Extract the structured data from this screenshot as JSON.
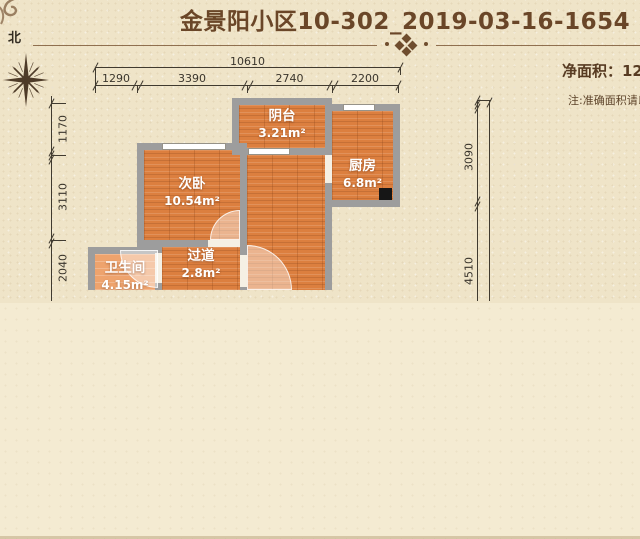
{
  "header": {
    "title": "金景阳小区10-302_2019-03-16-1654"
  },
  "compass": {
    "north_label": "北"
  },
  "info": {
    "net_area": "净面积：124",
    "note": "注:准确面积请以"
  },
  "dimensions": {
    "top_total": "10610",
    "top_segments": [
      "1290",
      "3390",
      "2740",
      "2200"
    ],
    "left_segments": [
      "1170",
      "3110",
      "2040"
    ],
    "right_segments": [
      "3090",
      "4510"
    ]
  },
  "rooms": {
    "balcony": {
      "name": "阴台",
      "area": "3.21m²"
    },
    "kitchen": {
      "name": "厨房",
      "area": "6.8m²"
    },
    "bedroom": {
      "name": "次卧",
      "area": "10.54m²"
    },
    "hallway": {
      "name": "过道",
      "area": "2.8m²"
    },
    "bathroom": {
      "name": "卫生间",
      "area": "4.15m²"
    }
  },
  "colors": {
    "background": "#efe4c8",
    "lower_band": "#f4ebd2",
    "title_text": "#6a4628",
    "divider": "#7f5c3b",
    "wall": "#9d9d9d",
    "wood_floor": "#dc7f3f",
    "tile_floor": "#eea36d",
    "dimension_text": "#3a352c"
  }
}
